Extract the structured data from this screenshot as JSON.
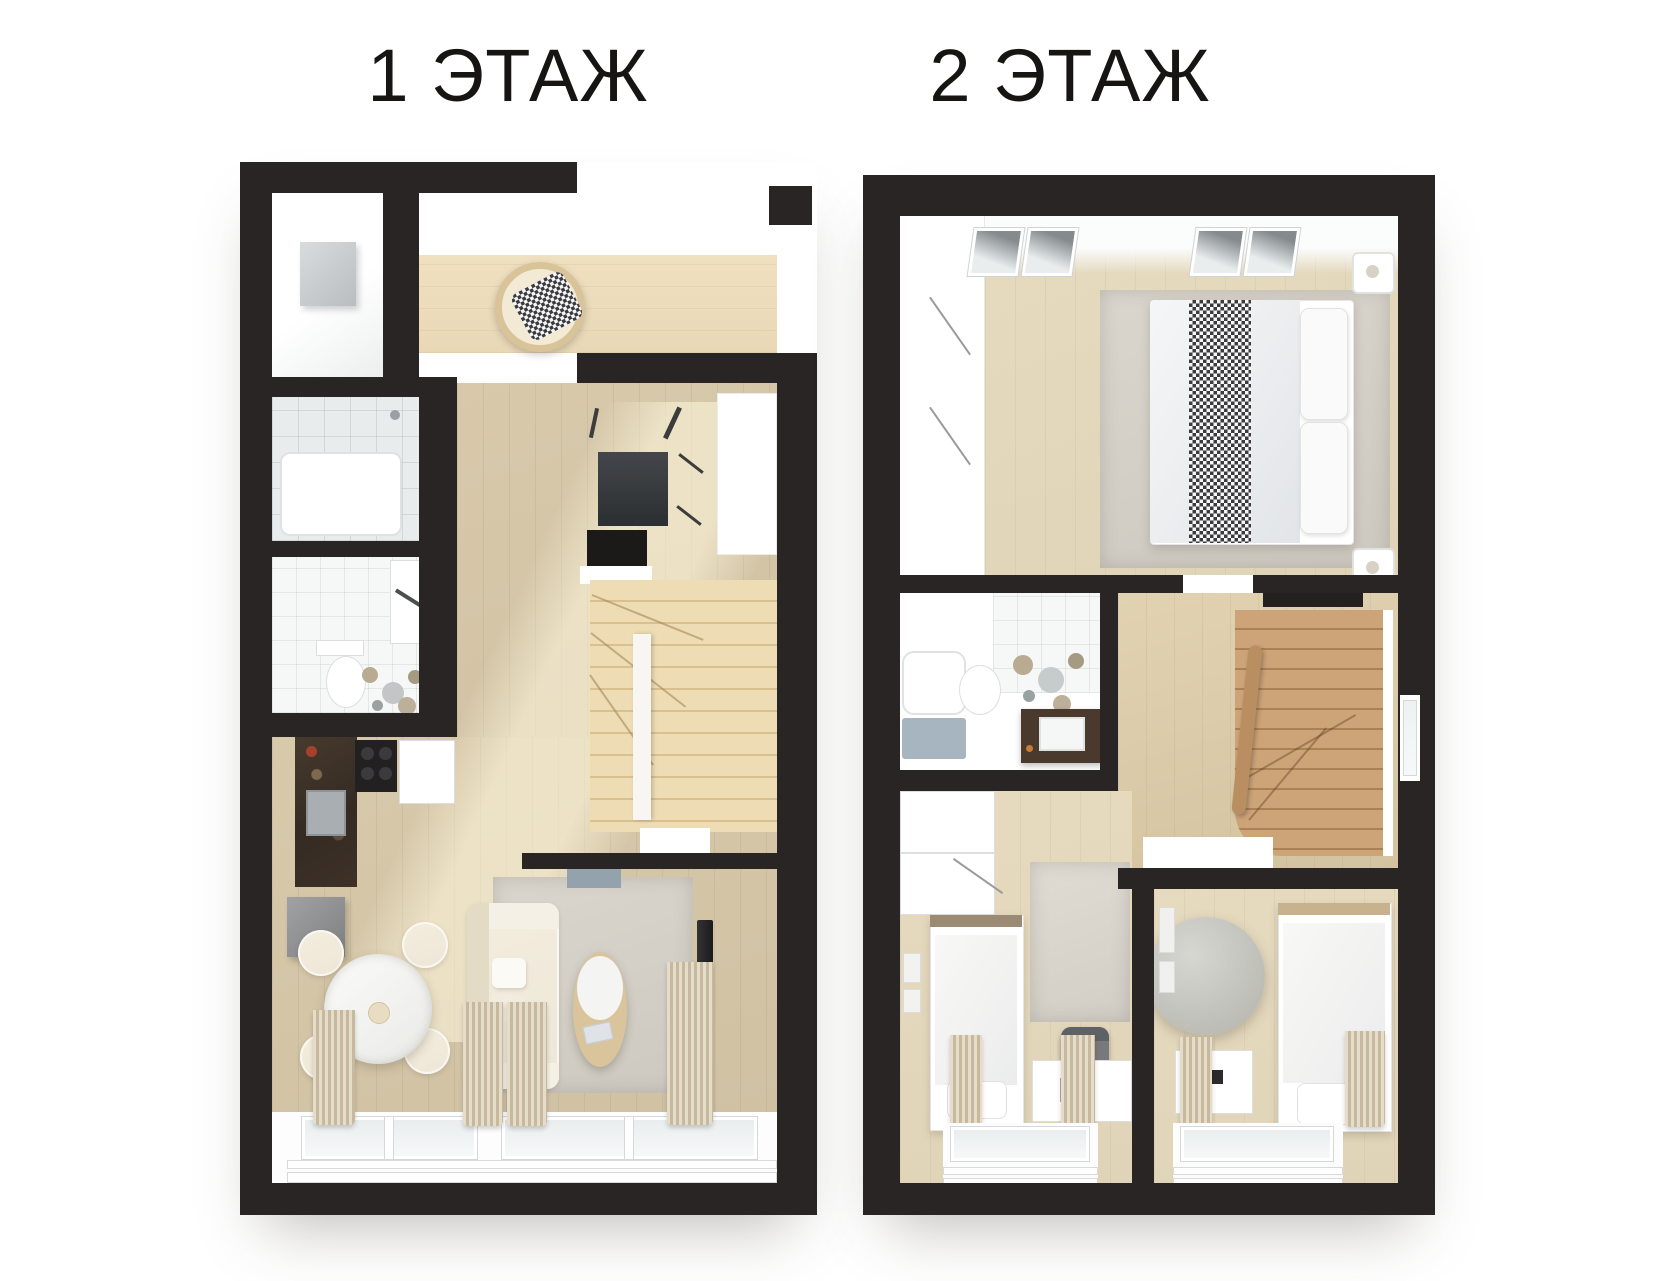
{
  "header": {
    "floor1_title": "1 ЭТАЖ",
    "floor2_title": "2 ЭТАЖ"
  },
  "colors": {
    "wall": "#2a2525",
    "bg": "#ffffff",
    "wood-hall": "#e9d8b6",
    "wood-floor": "#cfc0a2",
    "wood-light": "#e0d4b8",
    "stair-1f": "#e7d4ab",
    "stair-2f": "#c1976a",
    "rug": "#d6d2c9",
    "cream": "#eee7d8",
    "tile": "#e9eced",
    "marble-dark": "#352b23",
    "blue-gray": "#a6b5bf",
    "vanity-brown": "#4a392d",
    "curtain": "#d5c9b0",
    "tv-black": "#1b1b1d",
    "text": "#161514"
  }
}
